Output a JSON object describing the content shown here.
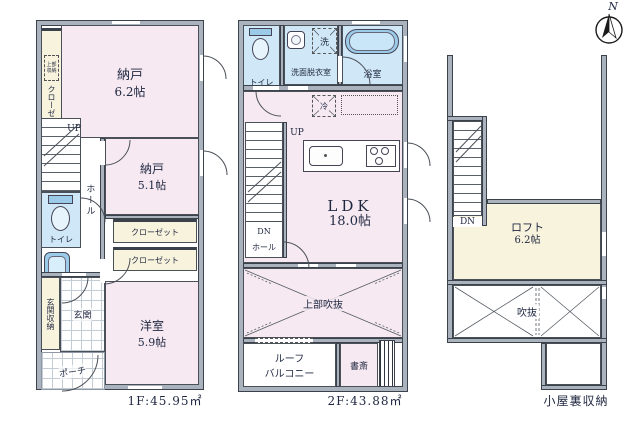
{
  "compass": {
    "north_label": "N"
  },
  "colors": {
    "wall": "#a9b2bd",
    "wall_line": "#3b424c",
    "room_pink": "#f6e9f2",
    "room_blue": "#cfe7f6",
    "room_cream": "#f8f3dd",
    "fixture_blue": "#9ccae9",
    "text": "#1f2740"
  },
  "floors": {
    "f1": {
      "title": "1F:45.95㎡",
      "rooms": {
        "nando1": "納戸",
        "nando1_size": "6.2帖",
        "nando2": "納戸",
        "nando2_size": "5.1帖",
        "yoshitsu": "洋室",
        "yoshitsu_size": "5.9帖",
        "closet": "クローゼット",
        "upper_storage": "上部収納",
        "hall": "ホール",
        "toilet": "トイレ",
        "entrance": "玄関",
        "entrance_storage": "玄関収納",
        "porch": "ポーチ",
        "up": "UP"
      }
    },
    "f2": {
      "title": "2F:43.88㎡",
      "rooms": {
        "toilet": "トイレ",
        "washroom": "洗面脱衣室",
        "bathroom": "浴室",
        "washer": "洗",
        "fridge": "冷",
        "ldk": "LDK",
        "ldk_size": "18.0帖",
        "void_above": "上部吹抜",
        "balcony_line1": "ルーフ",
        "balcony_line2": "バルコニー",
        "study": "書斎",
        "hall": "ホール",
        "up": "UP",
        "dn": "DN"
      }
    },
    "attic": {
      "title": "小屋裏収納",
      "rooms": {
        "loft": "ロフト",
        "loft_size": "6.2帖",
        "void": "吹抜",
        "dn": "DN"
      }
    }
  }
}
